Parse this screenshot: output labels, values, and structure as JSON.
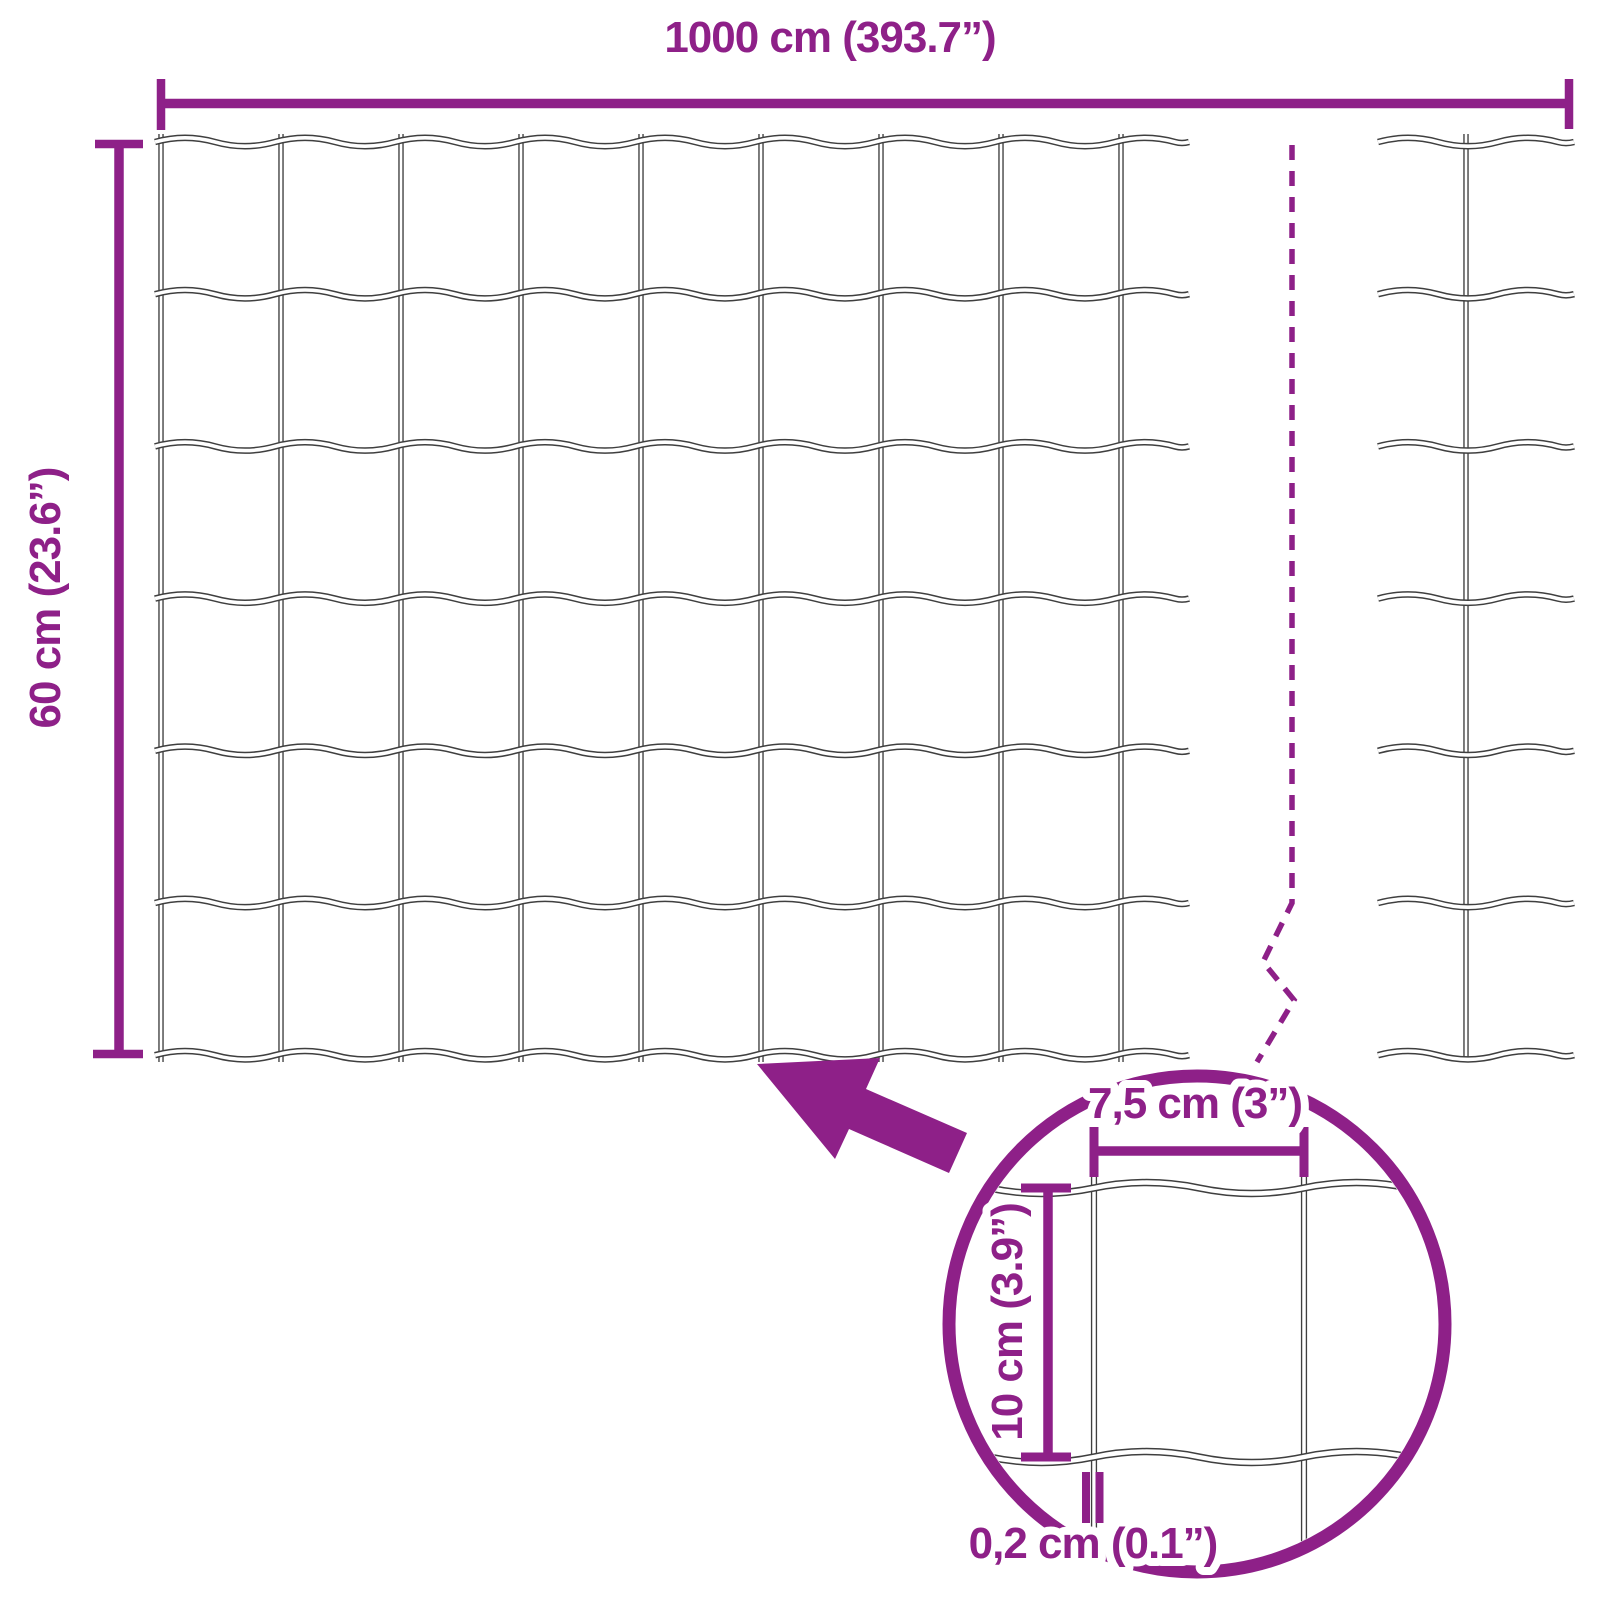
{
  "labels": {
    "total_width": "1000 cm (393.7”)",
    "total_height": "60 cm (23.6”)",
    "cell_width": "7,5 cm (3”)",
    "cell_height": "10 cm (3.9”)",
    "wire_diameter": "0,2 cm (0.1”)"
  },
  "mesh": {
    "main_section": {
      "horizontal_wires": 7,
      "vertical_wires": 9,
      "rows": 6,
      "columns": 8
    },
    "continuation_section": {
      "horizontal_wires": 7,
      "vertical_wires": 1
    },
    "lens_detail": {
      "horizontal_wires": 2,
      "vertical_wires": 2
    }
  },
  "colors": {
    "accent": "#8E2088",
    "wire_outline": "#3F3F3F",
    "background": "#FFFFFF"
  }
}
